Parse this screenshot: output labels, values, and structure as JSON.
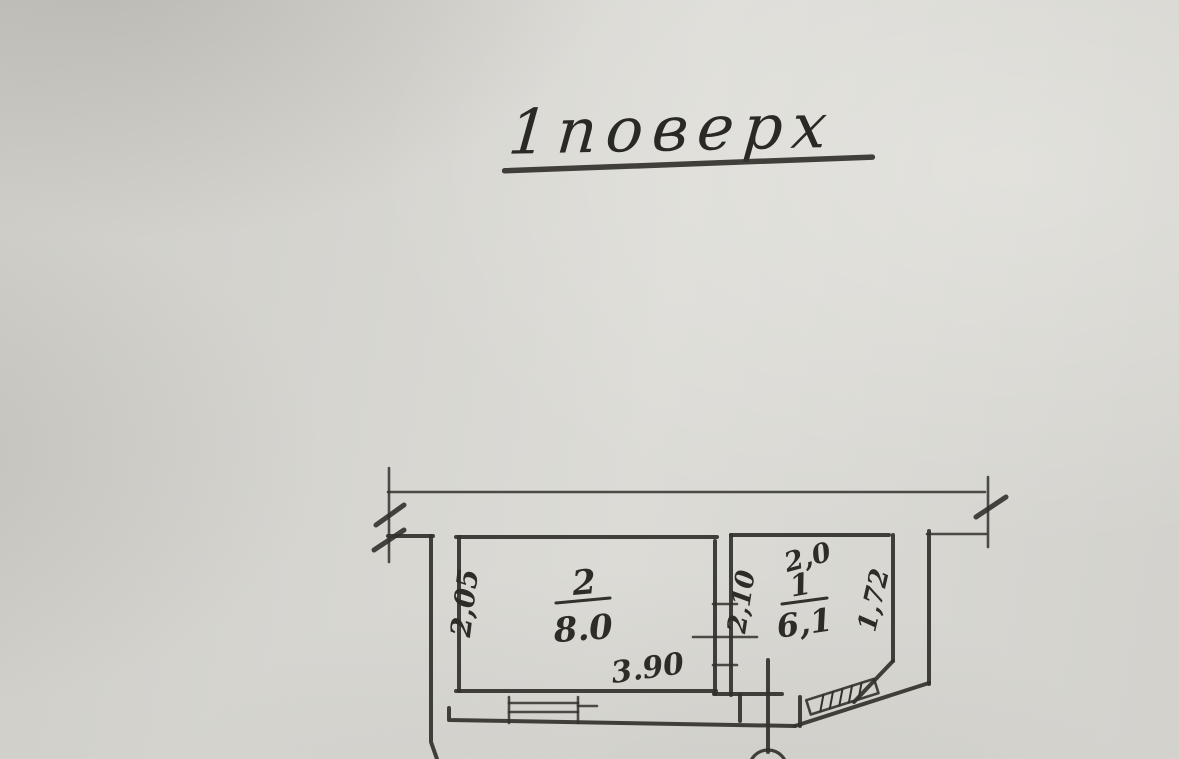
{
  "page": {
    "title": "1поверх"
  },
  "plan": {
    "room2": {
      "number": "2",
      "area": "8.0",
      "dim_left": "2,05",
      "dim_bottom": "3.90"
    },
    "room1": {
      "number": "1",
      "area": "6,1",
      "dim_top": "2,0",
      "dim_left": "2,10",
      "dim_right": "1,72"
    }
  }
}
